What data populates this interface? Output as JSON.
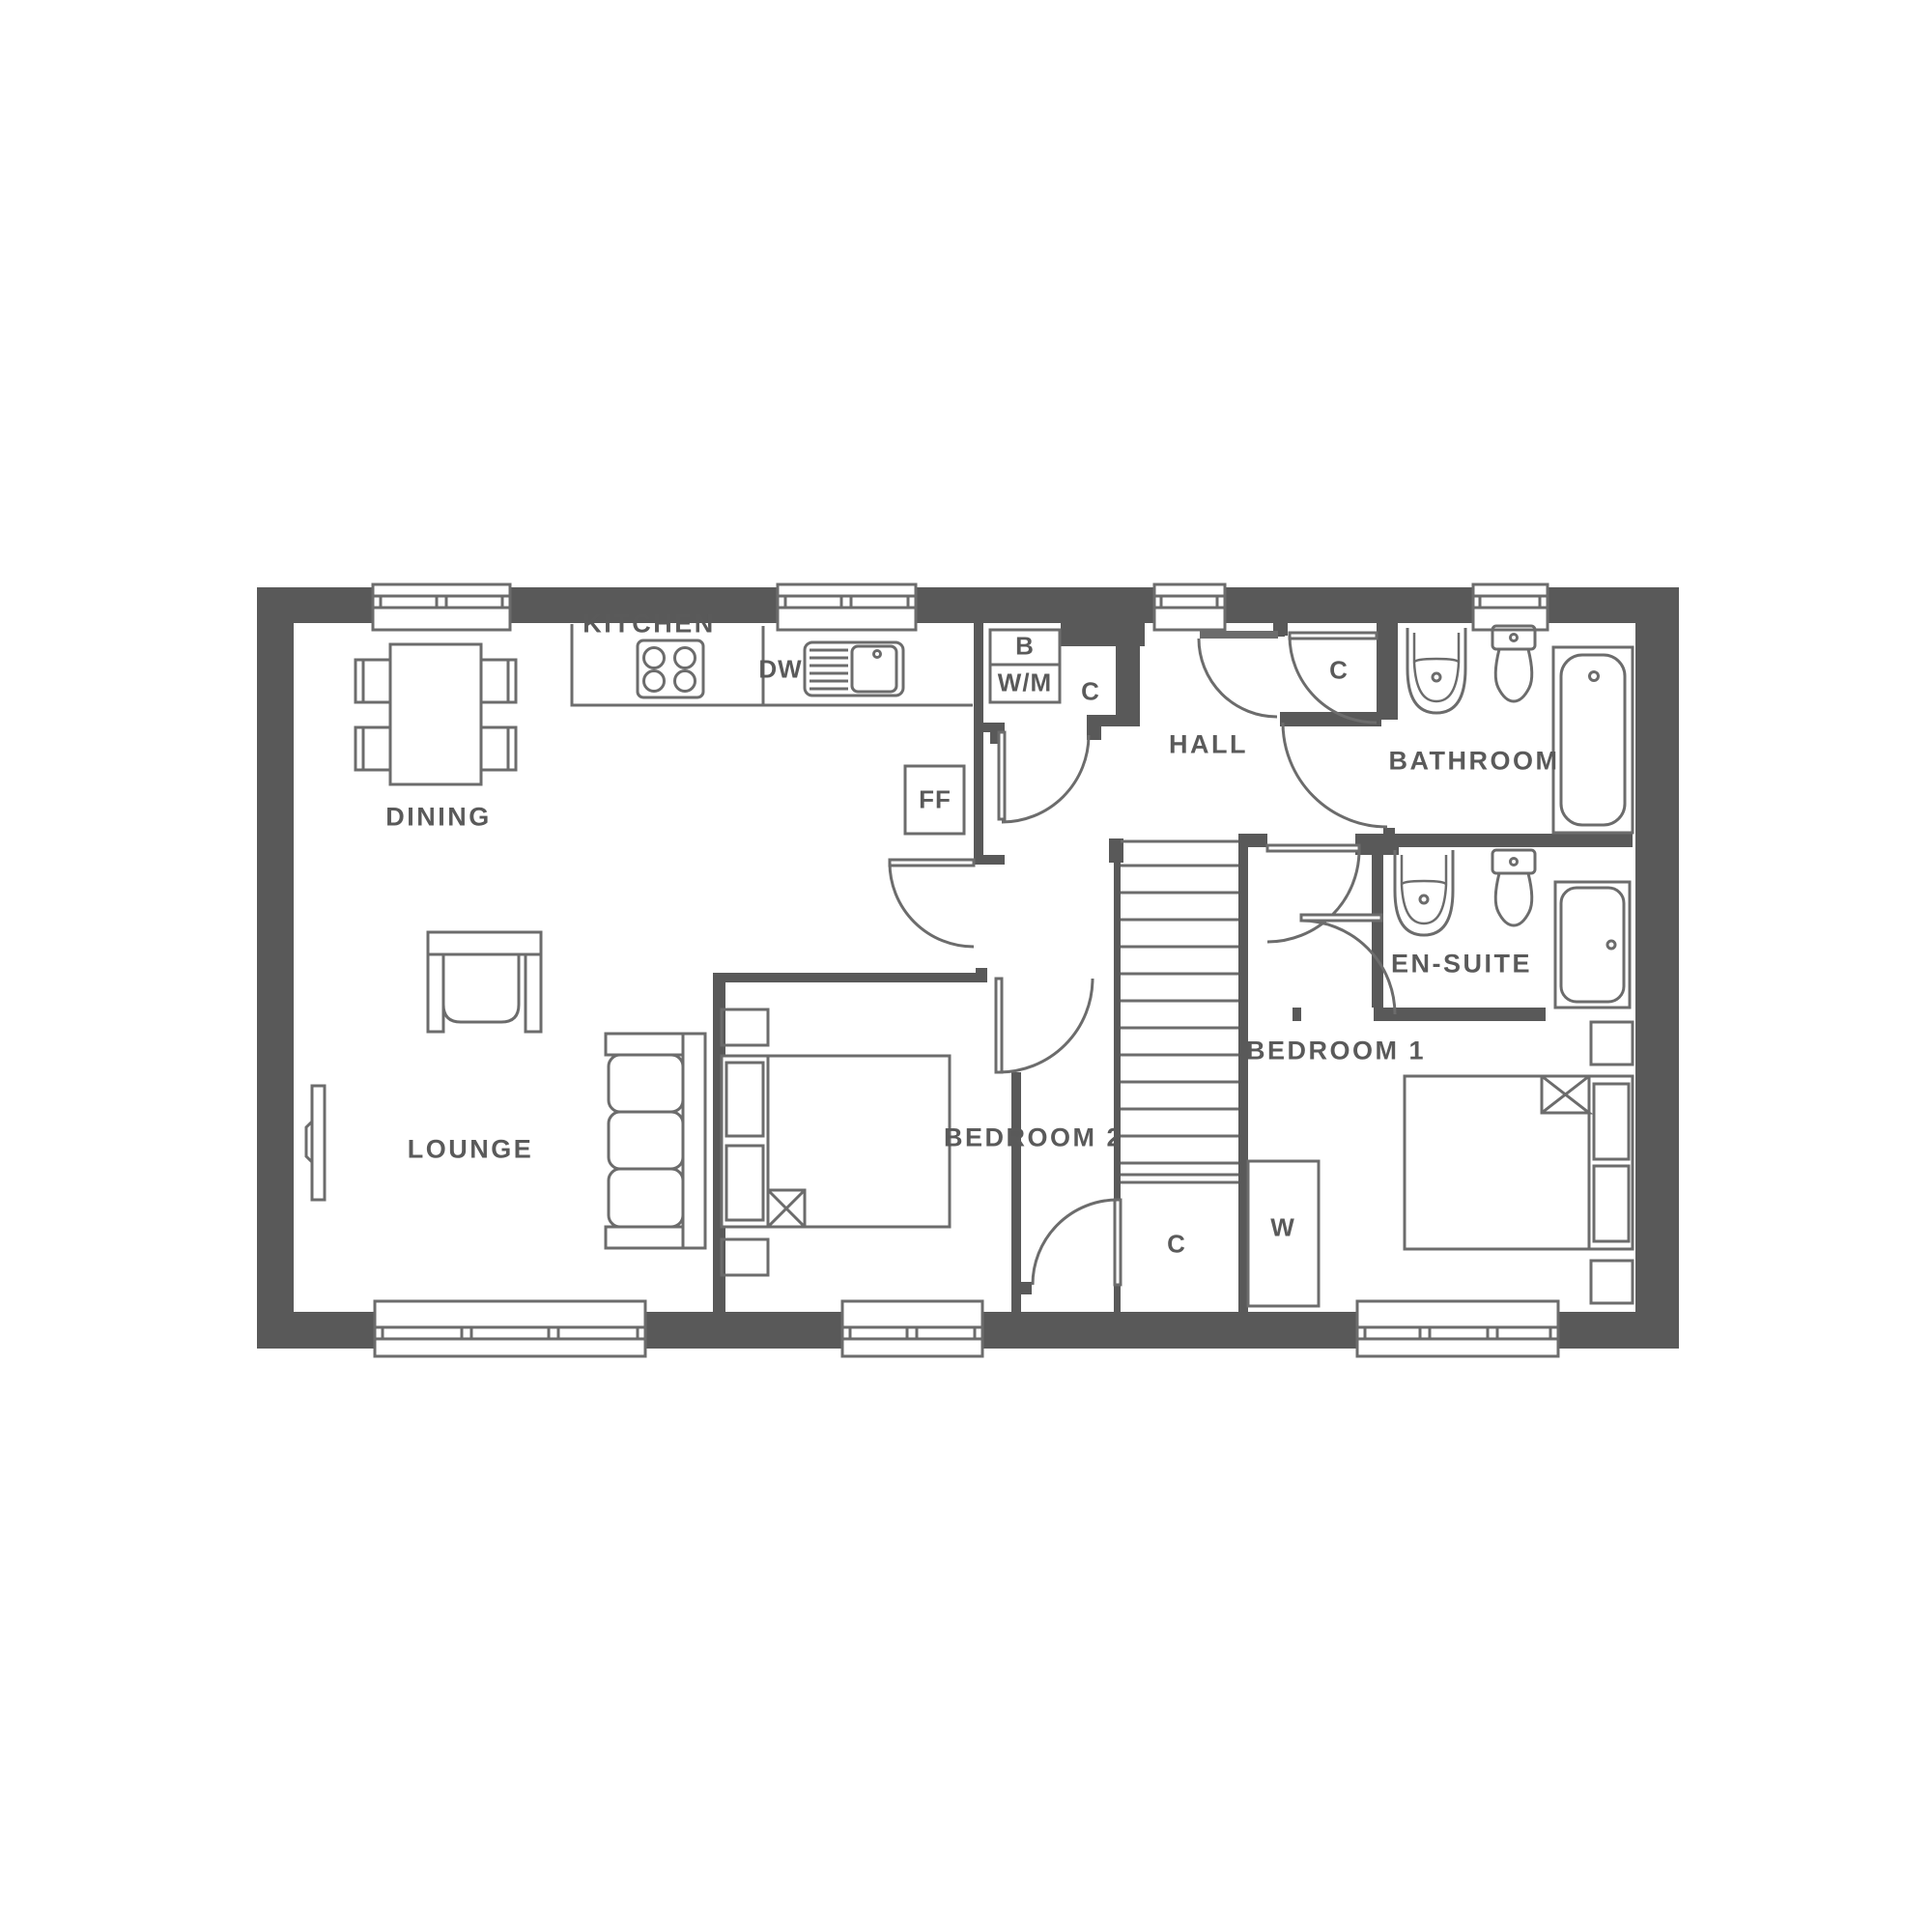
{
  "title": "Two bedroom house ground floor plan",
  "colors": {
    "wall": "#595959",
    "line": "#6c6c6c",
    "label_text": "#5a5a5a",
    "background": "#ffffff"
  },
  "labels": {
    "dining": "DINING",
    "kitchen": "KITCHEN",
    "lounge": "LOUNGE",
    "hall": "HALL",
    "bathroom": "BATHROOM",
    "en_suite": "EN-SUITE",
    "bedroom1": "BEDROOM 1",
    "bedroom2": "BEDROOM 2",
    "boiler": "B",
    "washing_machine": "W/M",
    "dishwasher": "DW",
    "fridge_freezer": "FF",
    "cupboard_utility": "C",
    "cupboard_hall": "C",
    "cupboard_understairs": "C",
    "wardrobe": "W"
  },
  "rooms": [
    {
      "name": "Dining"
    },
    {
      "name": "Kitchen"
    },
    {
      "name": "Lounge"
    },
    {
      "name": "Hall"
    },
    {
      "name": "Bathroom"
    },
    {
      "name": "En-suite"
    },
    {
      "name": "Bedroom 1"
    },
    {
      "name": "Bedroom 2"
    }
  ],
  "fixtures": [
    "dining-table",
    "dining-chairs",
    "kitchen-counter",
    "hob",
    "sink",
    "dishwasher-space",
    "fridge-freezer",
    "boiler-cupboard",
    "washing-machine",
    "armchair",
    "sofa",
    "tv",
    "staircase",
    "bath",
    "shower-bath",
    "basin",
    "toilet",
    "double-bed",
    "bedside-tables",
    "wardrobe",
    "windows",
    "doors"
  ]
}
